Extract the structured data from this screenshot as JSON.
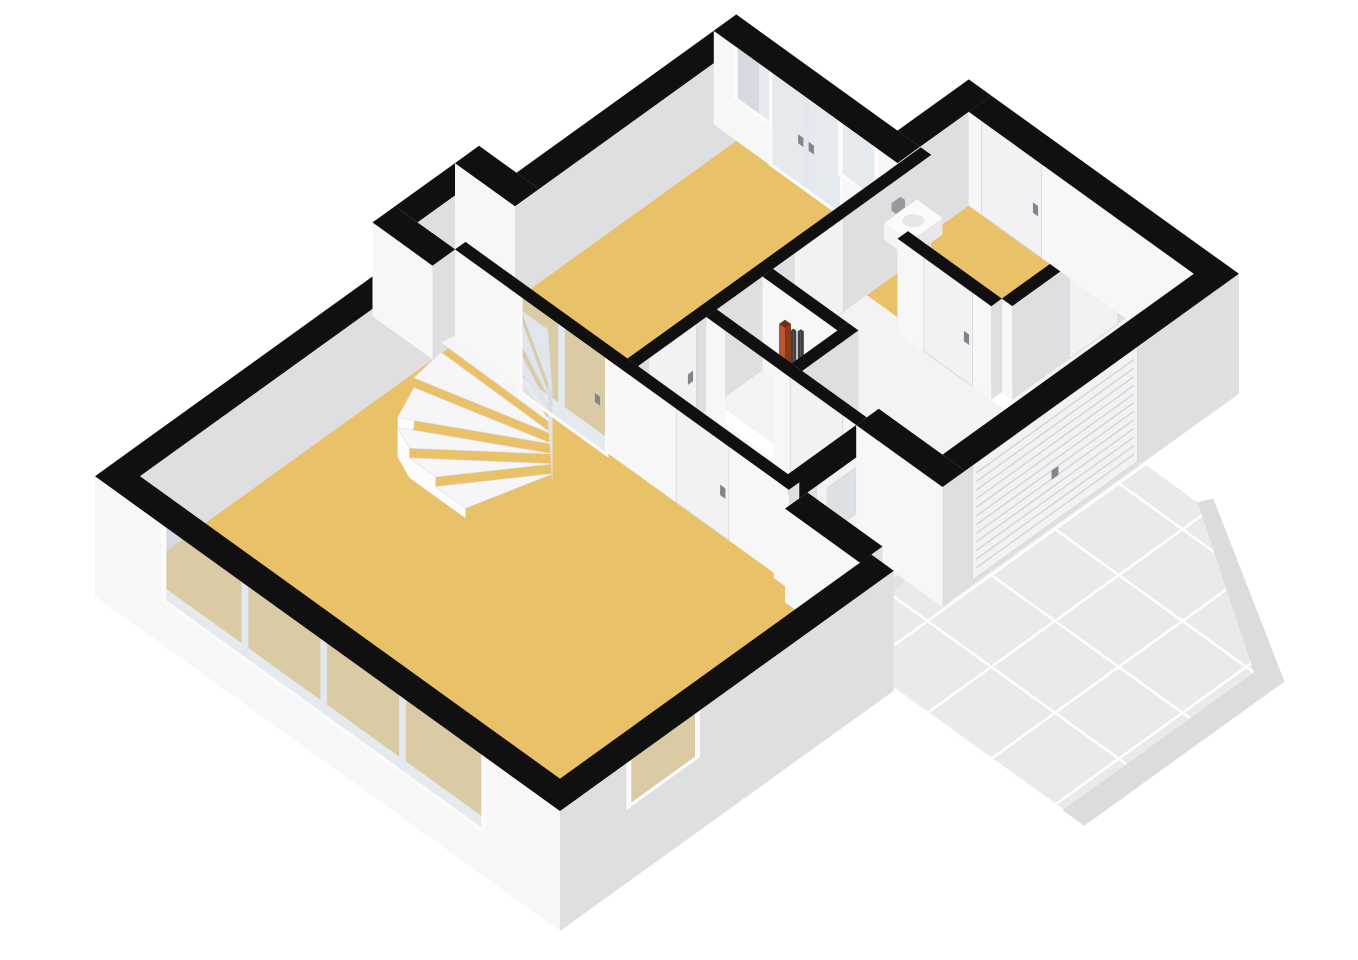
{
  "meta": {
    "title": "3D floor plan render — ground floor (living room, dining area, hall, meter closet, garage, toilet with sink, winder staircase, tiled driveway)",
    "view": "isometric cutaway, walls cut at ~1.25 m, tops filled black",
    "background": "#ffffff"
  },
  "scene": {
    "projection": {
      "ax": 75,
      "ay": 54,
      "az": 75,
      "x0": 95,
      "y0": 570,
      "wall_top_z": 1.25,
      "ground_z": -0.35
    },
    "colors": {
      "wall_top": "#101010",
      "face_sw": "#f7f7f8",
      "face_se": "#dfdfe2",
      "frame": "#fbfbfc",
      "glass": "rgba(203,214,223,0.5)",
      "frosted": "#dce1e5",
      "leaf": "#f2f2f4",
      "leaf_edge": "#d9d9dc",
      "handle": "#84858a",
      "rib": "#d6d6d9",
      "floor_yellow": "#e9c169",
      "floor_hall": "#f7f7f8",
      "floor_garage": "#f3f3f5",
      "floor_nook": "#f1f1f3",
      "floor_meter": "#ededf0",
      "tile": "#eaeaec",
      "tile_joint": "#ffffff",
      "tile_apron": "#dcdcdf",
      "step_top": "#f6f6f8",
      "step_edge": "#e3e3e7",
      "step_sw": "#fcfcfd",
      "step_se": "#e2e2e5",
      "sink_top": "#fbfbfc",
      "sink_sw": "#f4f4f6",
      "sink_se": "#e8e8eb",
      "basin": "#e3e7ea",
      "pipe_red_sw": "#bb5530",
      "pipe_red_se": "#8a3a1d",
      "pipe_red_top": "#6e2d15",
      "pipe_dark": "#3e3e43",
      "tap": "#97989d"
    },
    "floors": [
      {
        "id": "floor-living-room",
        "color": "floor_yellow",
        "rect": [
          0.3,
          0.3,
          4.5,
          5.9
        ]
      },
      {
        "id": "floor-dining-area",
        "color": "floor_yellow",
        "rect": [
          4.64,
          0.3,
          8.25,
          2.46
        ]
      },
      {
        "id": "floor-stair-nook",
        "color": "floor_nook",
        "rect": [
          4.5,
          -0.2,
          5.3,
          0.3
        ]
      },
      {
        "id": "floor-hall",
        "color": "floor_hall",
        "rect": [
          4.64,
          2.6,
          5.55,
          4.6
        ]
      },
      {
        "id": "floor-meter-closet",
        "color": "floor_meter",
        "rect": [
          5.69,
          2.6,
          6.3,
          3.6
        ]
      },
      {
        "id": "floor-garage-main",
        "color": "floor_garage",
        "rect": [
          5.69,
          2.6,
          7.55,
          5.45
        ]
      },
      {
        "id": "floor-garage-gap",
        "color": "floor_garage",
        "rect": [
          7.55,
          2.6,
          7.69,
          3.15
        ]
      },
      {
        "id": "floor-garage-side",
        "color": "floor_garage",
        "rect": [
          7.69,
          4.54,
          9.2,
          5.45
        ]
      },
      {
        "id": "floor-toilet-room",
        "color": "floor_yellow",
        "poly": [
          [
            7.69,
            2.6
          ],
          [
            8.55,
            2.6
          ],
          [
            8.55,
            2.45
          ],
          [
            9.2,
            2.45
          ],
          [
            9.2,
            4.4
          ],
          [
            7.69,
            4.4
          ]
        ]
      }
    ],
    "walls": [
      {
        "id": "wall-nw-living",
        "q1": 0.28,
        "p1": 0,
        "q2": 4.5,
        "p2": 0.3,
        "gsw": false,
        "gse": false,
        "openings": []
      },
      {
        "id": "wall-nook-west",
        "q1": 4.2,
        "p1": -0.5,
        "q2": 4.5,
        "p2": 0.3,
        "gsw": false,
        "gse": false,
        "openings": []
      },
      {
        "id": "wall-nook-nw",
        "q1": 4.5,
        "p1": -0.5,
        "q2": 5.3,
        "p2": -0.2,
        "gsw": false,
        "gse": false,
        "openings": []
      },
      {
        "id": "wall-nook-east",
        "q1": 5.3,
        "p1": -0.5,
        "q2": 5.62,
        "p2": 0.3,
        "gsw": false,
        "gse": false,
        "openings": []
      },
      {
        "id": "wall-nw-dining",
        "q1": 5.62,
        "p1": 0,
        "q2": 8.55,
        "p2": 0.3,
        "gsw": false,
        "gse": false,
        "openings": []
      },
      {
        "id": "wall-ne-dining-glazed",
        "q1": 8.25,
        "p1": 0,
        "q2": 8.55,
        "p2": 2.45,
        "gsw": false,
        "gse": false,
        "openings": [
          {
            "type": "window",
            "face": "sw",
            "s": [
              0.32,
              0.74
            ],
            "z": [
              0.58,
              1.25
            ]
          },
          {
            "type": "glassdoor",
            "face": "sw",
            "s": [
              0.78,
              1.68
            ],
            "z": [
              0.04,
              1.25
            ],
            "mull": [
              1.23
            ],
            "handles": [
              1.16,
              1.3
            ]
          },
          {
            "type": "window",
            "face": "sw",
            "s": [
              1.72,
              2.14
            ],
            "z": [
              0.58,
              1.25
            ]
          }
        ]
      },
      {
        "id": "wall-jog-ne",
        "q1": 8.55,
        "p1": 2.15,
        "q2": 9.5,
        "p2": 2.45,
        "gsw": false,
        "gse": false,
        "openings": []
      },
      {
        "id": "wall-ne-toilet",
        "q1": 9.2,
        "p1": 2.45,
        "q2": 9.5,
        "p2": 5.75,
        "gsw": false,
        "gse": true,
        "openings": [
          {
            "type": "door",
            "face": "sw",
            "s": [
              2.62,
              3.42
            ],
            "z": [
              0,
              1.25
            ],
            "handle": 3.34
          }
        ]
      },
      {
        "id": "wall-se-garage",
        "q1": 5.85,
        "p1": 5.45,
        "q2": 9.5,
        "p2": 5.75,
        "gsw": true,
        "gse": true,
        "openings": [
          {
            "type": "garage",
            "face": "se",
            "s": [
              5.95,
              8.15
            ],
            "z": [
              -0.28,
              1.25
            ],
            "handle": 7.05
          }
        ]
      },
      {
        "id": "wall-entry-return",
        "q1": 5.55,
        "p1": 4.6,
        "q2": 5.85,
        "p2": 5.75,
        "gsw": true,
        "gse": true,
        "openings": []
      },
      {
        "id": "wall-se-hall-front",
        "q1": 4.45,
        "p1": 4.6,
        "q2": 5.55,
        "p2": 4.9,
        "gsw": false,
        "gse": true,
        "openings": [
          {
            "type": "door",
            "face": "se",
            "s": [
              4.72,
              5.38
            ],
            "z": [
              -0.12,
              1.25
            ],
            "handle": 4.82,
            "frosted": [
              4.86,
              5.24,
              0.5,
              1.12
            ]
          }
        ]
      },
      {
        "id": "wall-jog-living",
        "q1": 4.3,
        "p1": 4.9,
        "q2": 4.6,
        "p2": 5.9,
        "gsw": false,
        "gse": true,
        "openings": []
      },
      {
        "id": "wall-se-living",
        "q1": 0,
        "p1": 5.9,
        "q2": 4.45,
        "p2": 6.2,
        "gsw": false,
        "gse": true,
        "openings": [
          {
            "type": "window",
            "face": "se",
            "s": [
              0.95,
              1.8
            ],
            "z": [
              0.68,
              1.25
            ]
          }
        ]
      },
      {
        "id": "wall-sw-living-windowband",
        "q1": 0,
        "p1": 0,
        "q2": 0.3,
        "p2": 6.2,
        "gsw": true,
        "gse": true,
        "openings": [
          {
            "type": "window",
            "face": "sw",
            "s": [
              0.95,
              5.15
            ],
            "z": [
              0.28,
              1.25
            ],
            "mull": [
              2.0,
              3.05,
              4.1
            ]
          }
        ]
      },
      {
        "id": "wall-living-hall",
        "q1": 4.5,
        "p1": 0.3,
        "q2": 4.64,
        "p2": 4.75,
        "gsw": false,
        "gse": false,
        "openings": [
          {
            "type": "glassdoor",
            "face": "sw",
            "s": [
              1.2,
              2.3
            ],
            "z": [
              0,
              1.25
            ],
            "mull": [
              1.72
            ],
            "handles": [
              2.2
            ]
          },
          {
            "type": "door",
            "face": "sw",
            "s": [
              3.25,
              3.95
            ],
            "z": [
              0,
              1.25
            ],
            "handle": 3.87
          }
        ]
      },
      {
        "id": "wall-dining-hall",
        "q1": 4.64,
        "p1": 2.46,
        "q2": 8.55,
        "p2": 2.6,
        "gsw": false,
        "gse": false,
        "openings": [
          {
            "type": "door",
            "face": "se",
            "s": [
              4.78,
              5.42
            ],
            "z": [
              0,
              1.25
            ],
            "handle": 5.34
          },
          {
            "type": "door",
            "face": "se",
            "s": [
              6.72,
              7.38
            ],
            "z": [
              0,
              1.25
            ],
            "handle": 6.8
          }
        ]
      },
      {
        "id": "wall-hall-garage",
        "q1": 5.55,
        "p1": 2.6,
        "q2": 5.69,
        "p2": 4.6,
        "gsw": false,
        "gse": false,
        "openings": [
          {
            "type": "opening",
            "face": "sw",
            "s": [
              2.85,
              3.5
            ],
            "z": [
              0,
              1.25
            ]
          },
          {
            "type": "door",
            "face": "sw",
            "s": [
              3.72,
              4.42
            ],
            "z": [
              0,
              1.25
            ],
            "handle": 4.34
          }
        ]
      },
      {
        "id": "wall-meter-closet-se",
        "q1": 5.69,
        "p1": 3.6,
        "q2": 6.44,
        "p2": 3.74,
        "gsw": false,
        "gse": false,
        "openings": []
      },
      {
        "id": "wall-meter-closet-ne",
        "q1": 6.3,
        "p1": 2.6,
        "q2": 6.44,
        "p2": 3.6,
        "gsw": false,
        "gse": false,
        "openings": []
      },
      {
        "id": "wall-toilet-garage-sw",
        "q1": 7.55,
        "p1": 3.15,
        "q2": 7.69,
        "p2": 4.4,
        "gsw": false,
        "gse": false,
        "openings": [
          {
            "type": "door",
            "face": "sw",
            "s": [
              3.5,
              4.15
            ],
            "z": [
              0,
              1.25
            ],
            "handle": 4.07
          }
        ]
      },
      {
        "id": "wall-toilet-garage-se",
        "q1": 7.69,
        "p1": 4.4,
        "q2": 9.2,
        "p2": 4.54,
        "gsw": false,
        "gse": false,
        "openings": [
          {
            "type": "door",
            "face": "se",
            "s": [
              8.45,
              9.1
            ],
            "z": [
              0,
              1.25
            ],
            "handle": 9.0
          }
        ]
      }
    ],
    "boxes": [
      {
        "id": "toilet-sink",
        "rect": [
          7.9,
          2.62,
          8.34,
          2.96
        ],
        "z": [
          0.6,
          0.82
        ],
        "ctop": "sink_top",
        "csw": "sink_sw",
        "cse": "sink_se",
        "basin": true
      },
      {
        "id": "sink-tap",
        "rect": [
          8.04,
          2.58,
          8.16,
          2.64
        ],
        "z": [
          0.86,
          0.96
        ],
        "ctop": "tap",
        "csw": "tap",
        "cse": "tap"
      },
      {
        "id": "meter-pipe-red",
        "rect": [
          6.06,
          3.06,
          6.14,
          3.14
        ],
        "z": [
          0,
          1.12
        ],
        "dbias": 0.35,
        "ctop": "pipe_red_top",
        "csw": "pipe_red_sw",
        "cse": "pipe_red_se"
      },
      {
        "id": "meter-pipe-dark-1",
        "rect": [
          6.19,
          3.08,
          6.23,
          3.12
        ],
        "z": [
          0,
          0.95
        ],
        "dbias": 0.35,
        "ctop": "pipe_dark",
        "csw": "pipe_dark",
        "cse": "pipe_dark"
      },
      {
        "id": "meter-pipe-dark-2",
        "rect": [
          6.27,
          3.1,
          6.31,
          3.14
        ],
        "z": [
          0,
          0.9
        ],
        "dbias": 0.35,
        "ctop": "pipe_dark",
        "csw": "pipe_dark",
        "cse": "pipe_dark"
      },
      {
        "id": "front-door-step",
        "rect": [
          4.62,
          4.92,
          5.48,
          5.3
        ],
        "z": [
          -0.32,
          -0.14
        ],
        "ctop": "step_top",
        "csw": "step_sw",
        "cse": "step_se"
      }
    ],
    "stairs": {
      "id": "winder-staircase",
      "pivot": [
        3.85,
        2.25
      ],
      "r": 1.5,
      "a0": 190,
      "a1": 335,
      "n": 9,
      "zstep": 0.132,
      "qmin": 2.95,
      "qmax": 4.42,
      "pmin": 0.42,
      "depth": -2.1
    },
    "driveway": {
      "id": "driveway-tiles",
      "z": -0.32,
      "poly": [
        [
          4.45,
          4.95
        ],
        [
          5.62,
          4.95
        ],
        [
          5.62,
          5.78
        ],
        [
          8.2,
          5.78
        ],
        [
          8.2,
          6.5
        ],
        [
          7.0,
          8.45
        ],
        [
          4.45,
          8.45
        ]
      ],
      "apron": [
        [
          4.45,
          8.45
        ],
        [
          7.0,
          8.45
        ],
        [
          8.2,
          6.5
        ],
        [
          8.34,
          6.57
        ],
        [
          7.12,
          8.74
        ],
        [
          4.45,
          8.74
        ]
      ],
      "grid_q": [
        4.45,
        5.3,
        6.15,
        7.0,
        7.85
      ],
      "grid_p": [
        4.95,
        5.8,
        6.65,
        7.5,
        8.35
      ],
      "qrange": [
        4.45,
        8.2
      ],
      "prange": [
        4.95,
        8.45
      ]
    }
  }
}
